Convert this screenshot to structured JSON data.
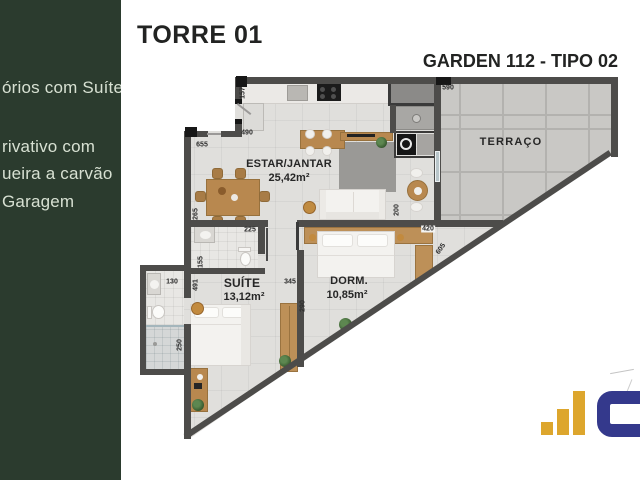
{
  "header": {
    "title": "TORRE 01",
    "unit": "GARDEN 112 - TIPO 02"
  },
  "sidebar": {
    "background": "#2b3b2e",
    "items": [
      "órios com Suíte",
      "rivativo com",
      "ueira a carvão",
      "Garagem"
    ]
  },
  "plan": {
    "rooms": [
      {
        "name": "ESTAR/JANTAR",
        "area": "25,42m²"
      },
      {
        "name": "TERRAÇO",
        "area": ""
      },
      {
        "name": "SUÍTE",
        "area": "13,12m²"
      },
      {
        "name": "DORM.",
        "area": "10,85m²"
      }
    ],
    "dims": [
      "157",
      "490",
      "655",
      "265",
      "225",
      "155",
      "130",
      "491",
      "345",
      "290",
      "250",
      "200",
      "420",
      "605",
      "590"
    ],
    "wall_color": "#4d4c4a",
    "wood_color": "#b8884f",
    "floor_color": "#e0dfdc",
    "terrace_tile_color": "#c9c8c5"
  },
  "logo": {
    "bar_color": "#dda62d",
    "mark_color": "#34398c"
  }
}
